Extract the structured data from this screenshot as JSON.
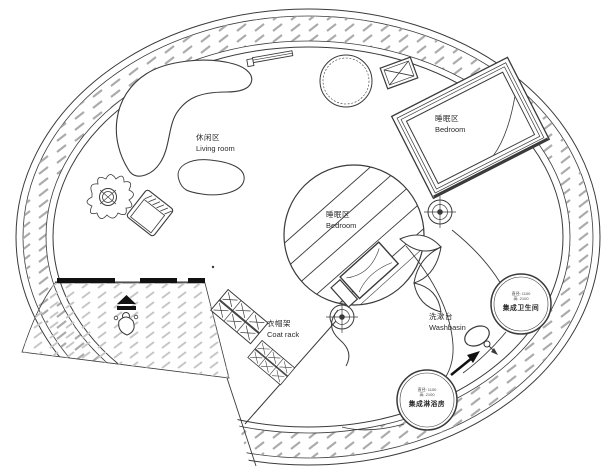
{
  "document": {
    "type": "architectural floor plan",
    "shape": "circular spiral house"
  },
  "rooms": {
    "living": {
      "zh": "休闲区",
      "en": "Living room"
    },
    "bedroom_upper": {
      "zh": "睡眠区",
      "en": "Bedroom"
    },
    "bedroom_center": {
      "zh": "睡眠区",
      "en": "Bedroom"
    },
    "coat_rack": {
      "zh": "衣帽架",
      "en": "Coat rack"
    },
    "washbasin": {
      "zh": "洗漱台",
      "en": "Washbasin"
    },
    "bathroom_pod": {
      "name": "集成卫生间",
      "spec_diameter": "直径: 1100",
      "spec_height": "高: 2100"
    },
    "shower_pod": {
      "name": "集成淋浴房",
      "spec_diameter": "直径: 1100",
      "spec_height": "高: 2100"
    }
  },
  "icons": [
    {
      "name": "ceiling-light-icon",
      "shape": "crosshair target, appears twice"
    },
    {
      "name": "plant-icon",
      "shape": "potted plant top view"
    },
    {
      "name": "person-icon",
      "shape": "person at entrance with canopy"
    },
    {
      "name": "faucet-icon",
      "shape": "tap loop with handle"
    },
    {
      "name": "door-arrow-icon",
      "shape": "entry direction arrow"
    },
    {
      "name": "ac-unit-icon",
      "shape": "crossed equipment box"
    }
  ],
  "colors": {
    "background": "#ffffff",
    "line": "#3a3a3a",
    "hatch_ring": "#ababab",
    "hatch_walkway": "#c6c6c6",
    "solid_black": "#111111"
  }
}
